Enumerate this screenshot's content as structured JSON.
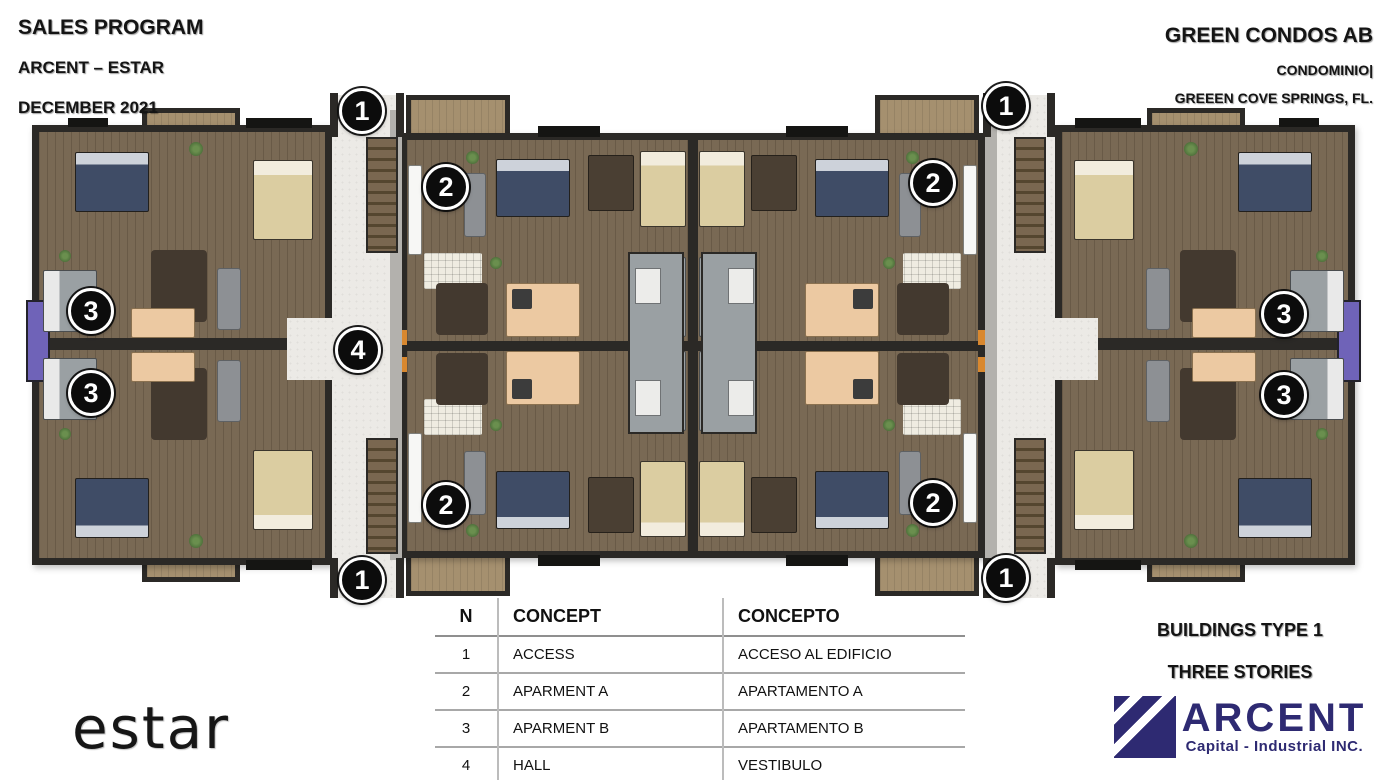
{
  "header_left": {
    "title": "SALES PROGRAM",
    "subtitle": "ARCENT – ESTAR",
    "date": "DECEMBER 2021"
  },
  "header_right": {
    "title": "GREEN CONDOS AB",
    "subtitle": "CONDOMINIO|",
    "location": "GREEEN COVE SPRINGS, FL."
  },
  "legend": {
    "headers": {
      "n": "N",
      "concept": "CONCEPT",
      "concepto": "CONCEPTO"
    },
    "rows": [
      {
        "n": "1",
        "concept": "ACCESS",
        "concepto": "ACCESO AL EDIFICIO"
      },
      {
        "n": "2",
        "concept": "APARMENT A",
        "concepto": "APARTAMENTO A"
      },
      {
        "n": "3",
        "concept": "APARMENT B",
        "concepto": "APARTAMENTO B"
      },
      {
        "n": "4",
        "concept": "HALL",
        "concepto": "VESTIBULO"
      }
    ]
  },
  "footer_right": {
    "line1": "BUILDINGS TYPE 1",
    "line2": "THREE STORIES"
  },
  "logos": {
    "estar_text": "estar",
    "arcent_name": "ARCENT",
    "arcent_tagline": "Capital - Industrial INC."
  },
  "markers": [
    {
      "label": "1",
      "x": 359,
      "y": 108
    },
    {
      "label": "1",
      "x": 1003,
      "y": 103
    },
    {
      "label": "2",
      "x": 443,
      "y": 184
    },
    {
      "label": "2",
      "x": 930,
      "y": 180
    },
    {
      "label": "3",
      "x": 88,
      "y": 308
    },
    {
      "label": "3",
      "x": 88,
      "y": 390
    },
    {
      "label": "4",
      "x": 355,
      "y": 347
    },
    {
      "label": "3",
      "x": 1281,
      "y": 311
    },
    {
      "label": "3",
      "x": 1281,
      "y": 392
    },
    {
      "label": "2",
      "x": 443,
      "y": 502
    },
    {
      "label": "2",
      "x": 930,
      "y": 500
    },
    {
      "label": "1",
      "x": 359,
      "y": 577
    },
    {
      "label": "1",
      "x": 1003,
      "y": 575
    }
  ],
  "colors": {
    "accent_navy": "#2e2a72",
    "marker_bg": "#0c0c0c",
    "wall": "#2b2926",
    "wood": "#75644f",
    "walkway": "#eceae6",
    "kitchen": "#ecc9a2",
    "purple_accent": "#6f63b8"
  }
}
